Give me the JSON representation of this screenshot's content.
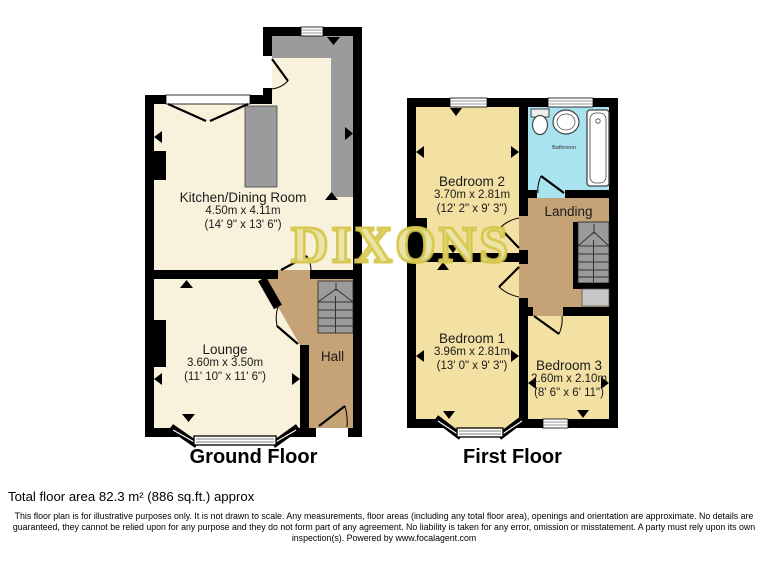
{
  "watermark": "DIXONS",
  "colors": {
    "wall_black": "#000000",
    "room_cream": "#f8f2dc",
    "room_yellow": "#f3e1a4",
    "hall_tan": "#c5a377",
    "bathroom_blue": "#a9e3ef",
    "counter_gray": "#9b9b9b",
    "watermark_yellow": "#d5c74a"
  },
  "ground_floor": {
    "caption": "Ground Floor",
    "rooms": {
      "kitchen": {
        "name": "Kitchen/Dining Room",
        "metric": "4.50m x 4.11m",
        "imperial": "(14' 9\" x 13' 6\")"
      },
      "lounge": {
        "name": "Lounge",
        "metric": "3.60m x 3.50m",
        "imperial": "(11' 10\" x 11' 6\")"
      },
      "hall": {
        "name": "Hall"
      }
    }
  },
  "first_floor": {
    "caption": "First Floor",
    "rooms": {
      "bedroom2": {
        "name": "Bedroom 2",
        "metric": "3.70m x 2.81m",
        "imperial": "(12' 2\" x 9' 3\")"
      },
      "bathroom": {
        "name": "Bathroom"
      },
      "landing": {
        "name": "Landing"
      },
      "bedroom1": {
        "name": "Bedroom 1",
        "metric": "3.96m x 2.81m",
        "imperial": "(13' 0\" x 9' 3\")"
      },
      "bedroom3": {
        "name": "Bedroom 3",
        "metric": "2.60m x 2.10m",
        "imperial": "(8' 6\" x 6' 11\")"
      }
    }
  },
  "footer": {
    "total_area": "Total floor area 82.3 m² (886 sq.ft.) approx",
    "disclaimer": "This floor plan is for illustrative purposes only. It is not drawn to scale. Any measurements, floor areas (including any total floor area), openings and orientation are approximate. No details are guaranteed, they cannot be relied upon for any purpose and they do not form part of any agreement. No liability is taken for any error, omission or misstatement. A party must rely upon its own inspection(s). Powered by www.focalagent.com"
  }
}
